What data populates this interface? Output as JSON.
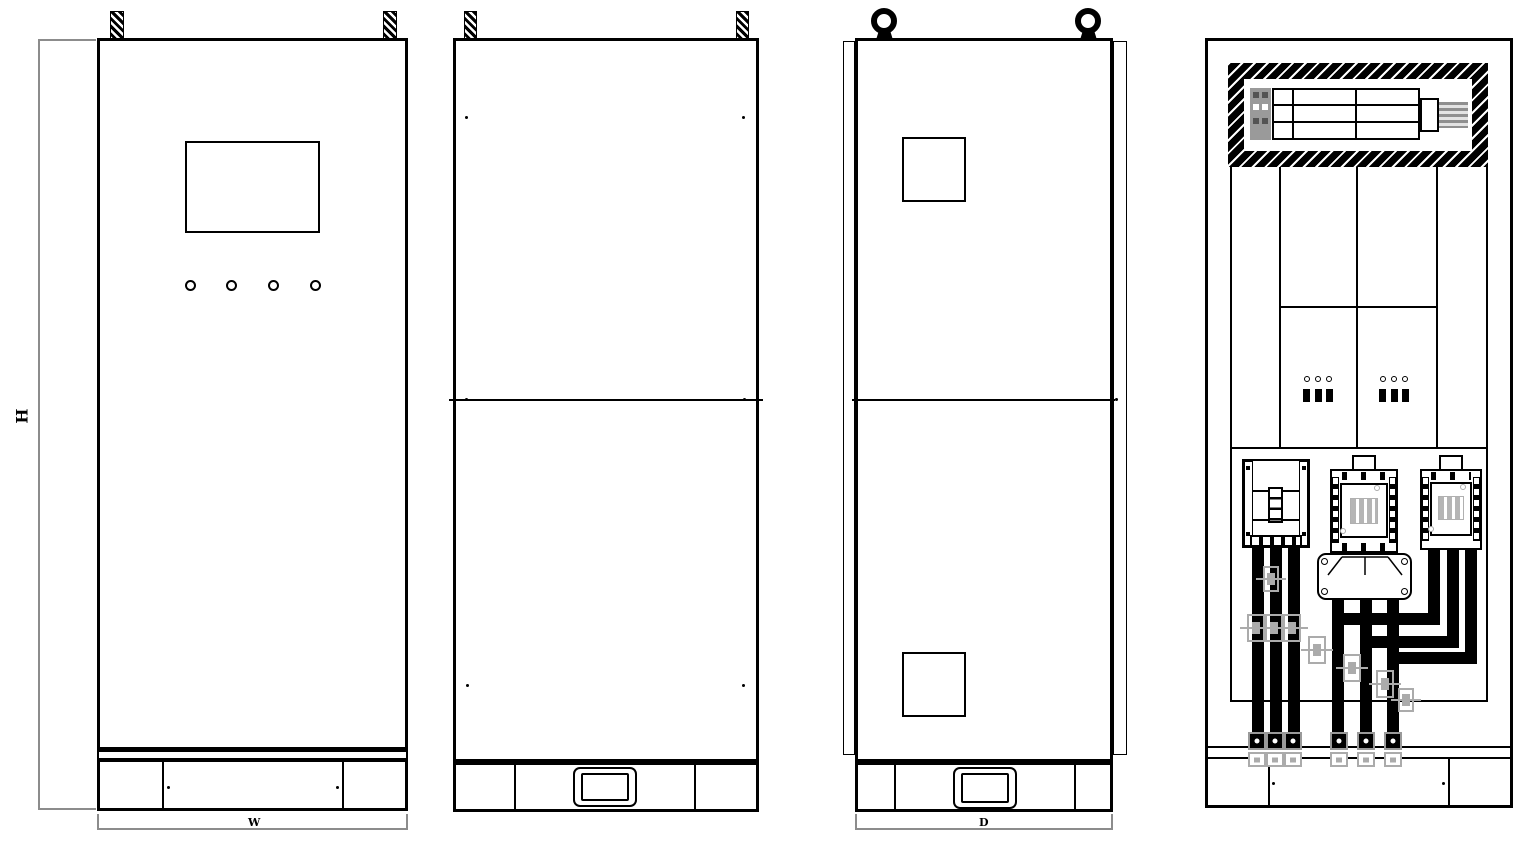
{
  "drawing": {
    "dimension_labels": {
      "height": "H",
      "width": "W",
      "depth": "D"
    },
    "colors": {
      "line": "#000000",
      "dimension_line": "#8c8c8c",
      "ghost_outline": "#ababab",
      "background": "#ffffff"
    },
    "icons": {
      "lifting_tab": "hatched-bar",
      "lifting_eye": "ring",
      "door_handle": "rounded-rect",
      "indicator_light": "circle"
    }
  }
}
